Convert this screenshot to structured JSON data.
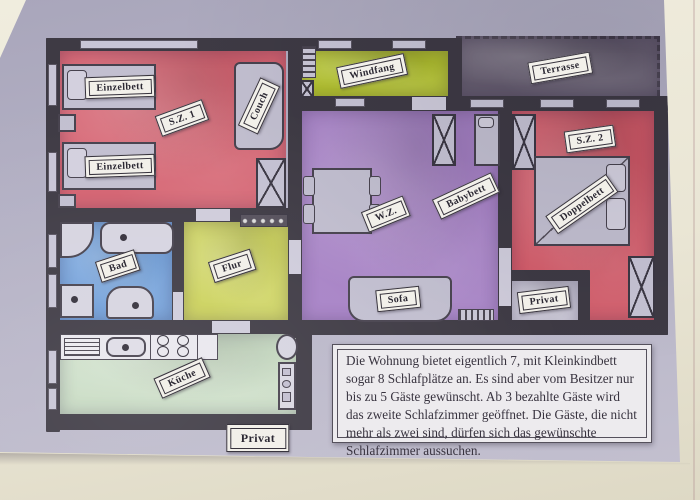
{
  "floorplan": {
    "room_labels": {
      "sz1": "S.Z. 1",
      "windfang": "Windfang",
      "terrasse": "Terrasse",
      "wz": "W.Z.",
      "sz2": "S.Z. 2",
      "bad": "Bad",
      "flur": "Flur",
      "kueche": "Küche"
    },
    "furniture_labels": {
      "einzelbett_1": "Einzelbett",
      "einzelbett_2": "Einzelbett",
      "couch": "Couch",
      "babybett": "Babybett",
      "doppelbett": "Doppelbett",
      "sofa": "Sofa",
      "privat_sz2": "Privat",
      "privat_entrance": "Privat"
    },
    "note_text": "Die Wohnung bietet eigentlich 7, mit Kleinkindbett sogar 8 Schlafplätze an. Es sind aber vom Besitzer nur bis zu 5 Gäste gewünscht. Ab 3 bezahlte Gäste wird das zweite Schlafzimmer geöffnet. Die Gäste, die nicht mehr als zwei sind, dürfen sich das gewünschte Schlafzimmer aussuchen.",
    "colors": {
      "paper": "#b4b1c5",
      "wall": "#3e3a44",
      "sz1": "#d56371",
      "sz2": "#d25а68",
      "sz2_fix": "#d25a68",
      "windfang": "#b5c42f",
      "terrasse": "#675e70",
      "wz": "#a782c6",
      "bad": "#6f9ed9",
      "flur": "#ccd25c",
      "kueche": "#c9dcc4",
      "privat_nook": "#c6c3d3",
      "plaque_bg": "#f2f0ea",
      "note_bg": "#edebee"
    }
  }
}
